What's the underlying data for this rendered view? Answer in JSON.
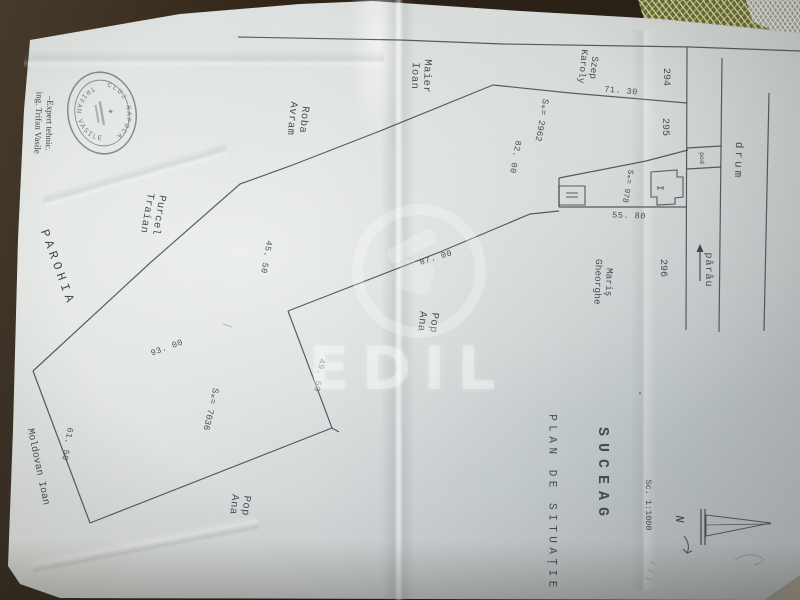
{
  "titleblock": {
    "locality": "SUCEAG",
    "title": "PLAN DE SITUAȚIE",
    "scale": "Sc. 1:1000",
    "north": "N"
  },
  "certification": {
    "line1": "–Expert tehnic.",
    "line2": "ing. Trifan Vasile",
    "stamp_ring_top": "CLUJ-NAPOCA",
    "stamp_ring_bottom": "TRIFAN VASILE",
    "stamp_star": "✶"
  },
  "neighbors": {
    "maier": [
      "Maier",
      "Ioan"
    ],
    "roba": [
      "Roba",
      "Avram"
    ],
    "purcel": [
      "Purcel",
      "Traian"
    ],
    "parohia": "PAROHIA",
    "moldovan": "Moldovan  Ioan",
    "pop_center": [
      "Pop",
      "Ana"
    ],
    "pop_south": [
      "Pop",
      "Ana"
    ],
    "maris": [
      "Mariş",
      "Gheorghe"
    ],
    "szep": [
      "Szep",
      "Karoly"
    ]
  },
  "lot_numbers": {
    "lot_294": "294",
    "lot_295": "295",
    "lot_296": "296"
  },
  "features": {
    "road": "drum",
    "stream": "pârâu",
    "bridge": "pod",
    "building_main": "I"
  },
  "areas": {
    "upper_parcel": "Sₘ= 2962",
    "courtyard": "Sₘ= 978",
    "lower_parcel": "Sₘ= 7036"
  },
  "dimensions": {
    "d71": "71. 30",
    "d82": "82. 00",
    "d55": "55. 80",
    "d45": "45. 50",
    "d87": "87. 00",
    "d93": "93. 00",
    "d49": "49. 50",
    "d61": "61. 50"
  },
  "watermark": {
    "text": "EDIL"
  },
  "colors": {
    "ink": "#3a414b",
    "paper": "#d8dcdb",
    "background": "#2b2015",
    "stamp_ink": "#4d5868",
    "lace": "#d6da8c",
    "watermark": "#ffffff"
  }
}
